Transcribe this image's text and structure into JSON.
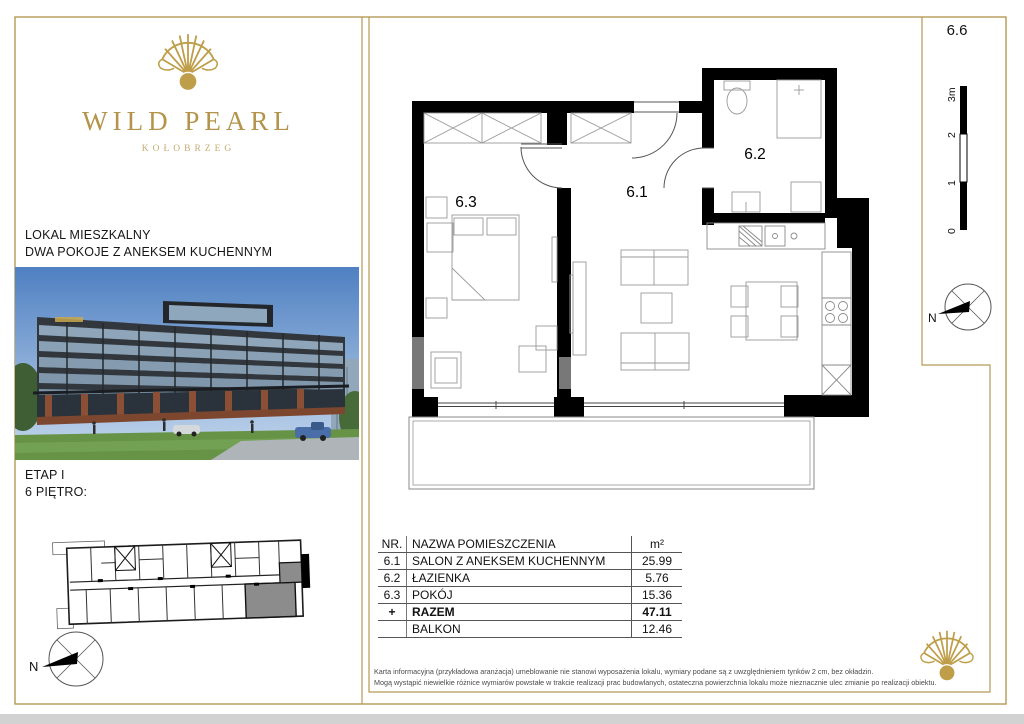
{
  "brand": {
    "name": "WILD PEARL",
    "city": "KOŁOBRZEG"
  },
  "listing": {
    "category": "LOKAL MIESZKALNY",
    "layout": "DWA POKOJE Z ANEKSEM KUCHENNYM",
    "stage": "ETAP I",
    "floor": "6 PIĘTRO:"
  },
  "unit_number": "6.6",
  "floor_plan": {
    "rooms": {
      "living": "6.1",
      "bath": "6.2",
      "bedroom": "6.3"
    },
    "scale": {
      "labels": [
        "0",
        "1",
        "2",
        "3m"
      ]
    },
    "compass_label": "N"
  },
  "area_table": {
    "header": {
      "nr": "NR.",
      "name": "NAZWA POMIESZCZENIA",
      "area": "m²"
    },
    "rows": [
      {
        "nr": "6.1",
        "name": "SALON Z ANEKSEM KUCHENNYM",
        "area": "25.99"
      },
      {
        "nr": "6.2",
        "name": "ŁAZIENKA",
        "area": "5.76"
      },
      {
        "nr": "6.3",
        "name": "POKÓJ",
        "area": "15.36"
      },
      {
        "nr": "+",
        "name": "RAZEM",
        "area": "47.11"
      },
      {
        "nr": "",
        "name": "BALKON",
        "area": "12.46"
      }
    ]
  },
  "disclaimer": {
    "line1": "Karta informacyjna (przykładowa aranżacja) umeblowanie nie stanowi wyposażenia lokalu, wymiary podane są z uwzględnieniem tynków 2 cm, bez okładzin.",
    "line2": "Mogą wystąpić niewielkie różnice wymiarów powstałe w trakcie realizacji prac budowlanych, ostateczna powierzchnia lokalu może nieznacznie ulec zmianie po realizacji obiektu."
  },
  "colors": {
    "gold": "#b49a55",
    "logo_gold": "#bf9e4a",
    "wall": "#000000",
    "unit_highlight": "#8c8c8c"
  }
}
